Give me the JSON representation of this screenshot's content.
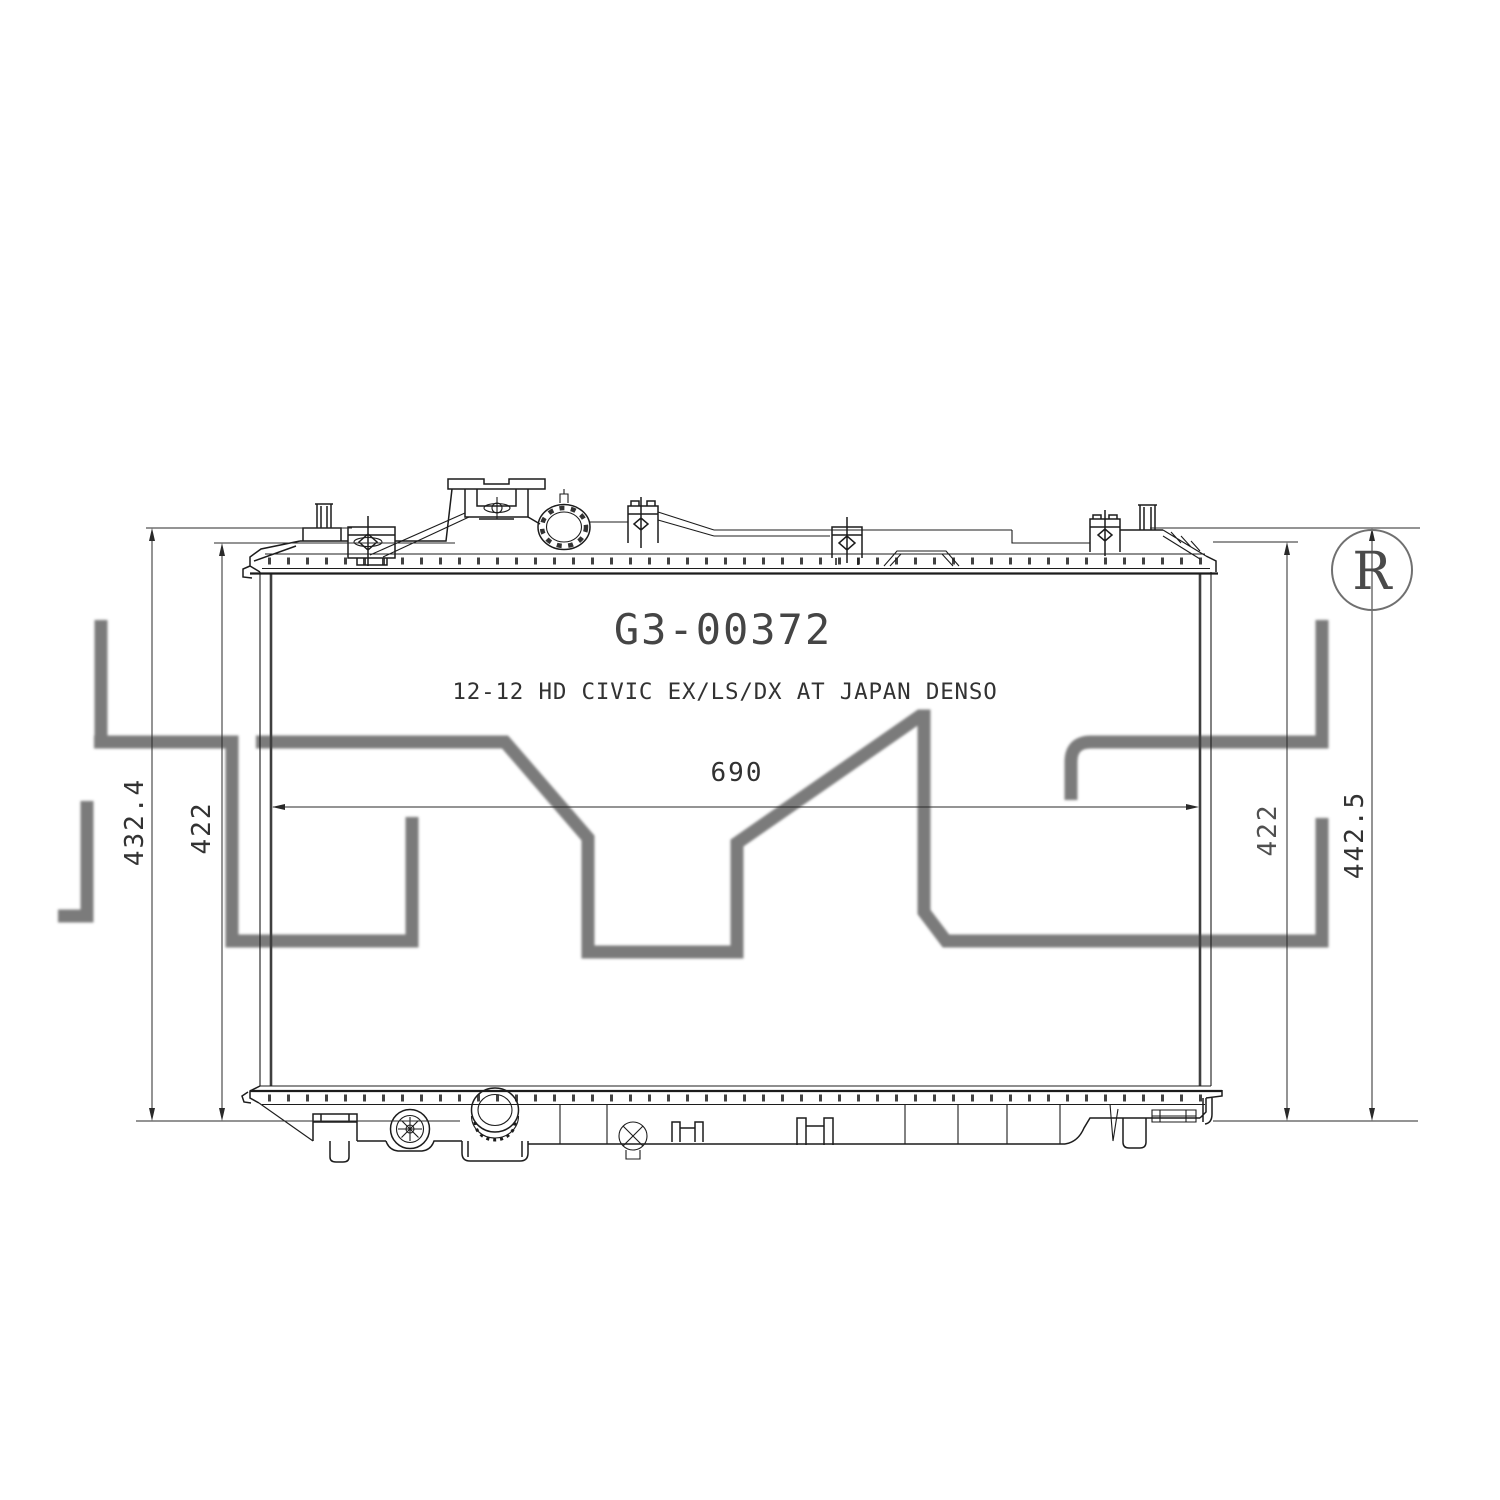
{
  "page": {
    "background": "#ffffff"
  },
  "drawing": {
    "part_number": "G3-00372",
    "description": "12-12 HD CIVIC EX/LS/DX AT JAPAN DENSO",
    "registered_mark_letter": "R",
    "watermark_logo": "TYC",
    "colors": {
      "line": "#1c1c1c",
      "dimension": "#2a2a2a",
      "text": "#3c3c3c",
      "watermark": "#4f4f4f"
    },
    "dims": {
      "overall_width": "690",
      "left_outer_height": "432.4",
      "left_inner_height": "422",
      "right_inner_height": "422",
      "right_outer_height": "442.5"
    }
  }
}
